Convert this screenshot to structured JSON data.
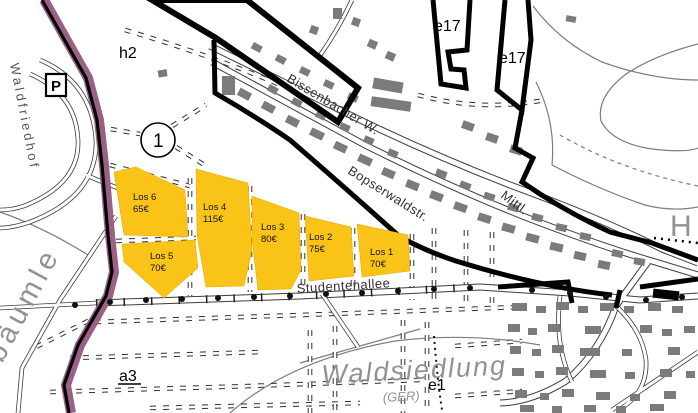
{
  "parcels": [
    {
      "label": "Los 1",
      "price": "70€"
    },
    {
      "label": "Los 2",
      "price": "75€"
    },
    {
      "label": "Los 3",
      "price": "80€"
    },
    {
      "label": "Los 4",
      "price": "115€"
    },
    {
      "label": "Los 5",
      "price": "70€"
    },
    {
      "label": "Los 6",
      "price": "65€"
    }
  ],
  "streets": {
    "studentenallee": "Studentenallee",
    "bopserwaldstr": "Bopserwaldstr.",
    "bissenbacher": "Bissenbacher W.",
    "mittl": "Mittl.",
    "waldfriedhof": "Waldfriedhof"
  },
  "areas": {
    "waldsiedlung": "Waldsiedlung",
    "region_code": "(GER)",
    "baeumle": "bäumle",
    "h_label": "H"
  },
  "markers": {
    "h2": "h2",
    "e17_left": "e17",
    "e17_right": "e17",
    "e1": "e1",
    "a3": "a3",
    "parking": "P",
    "circle_number": "1"
  },
  "colors": {
    "parcel_fill": "#FAC318",
    "boundary_stripe": "#9C6087",
    "building_gray": "#7B7B7B"
  }
}
